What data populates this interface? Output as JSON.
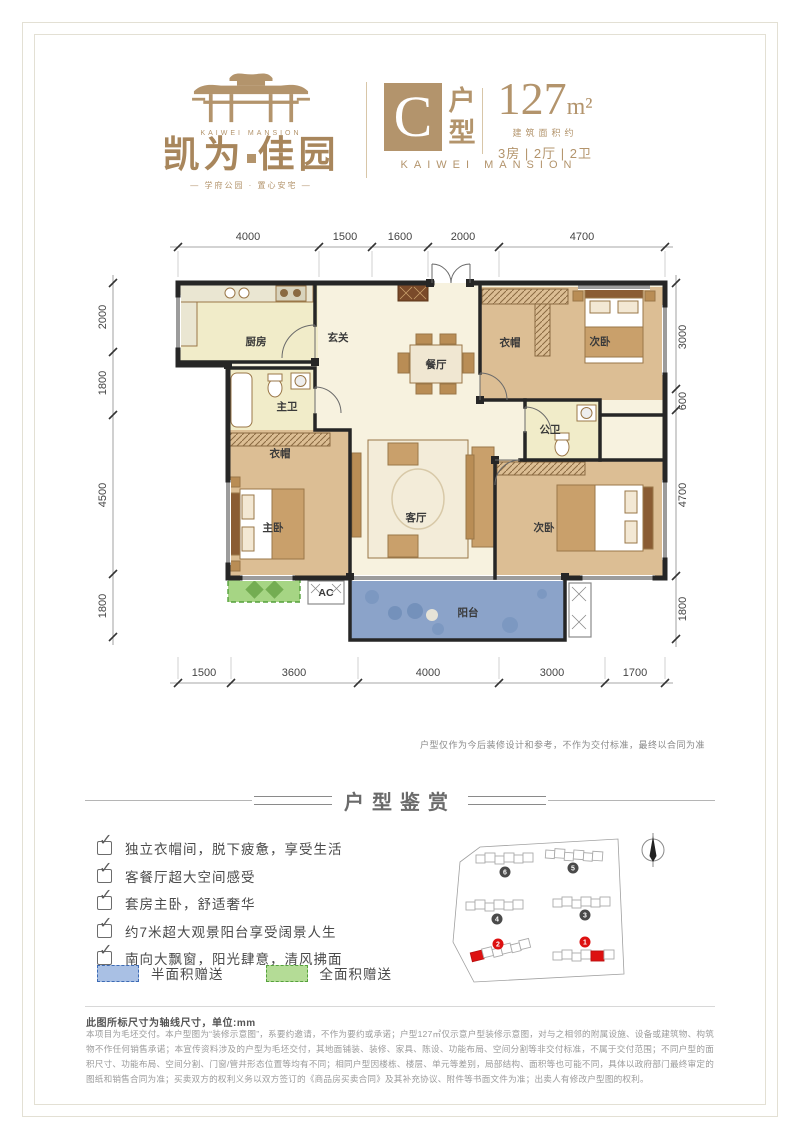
{
  "colors": {
    "accent": "#b3946c",
    "wall": "#262626",
    "balcony_fill": "#8ba3c9",
    "balcony_border": "#3c66ad",
    "gift_green_fill": "#a6d584",
    "gift_green_border": "#55a13c",
    "legend_blue": "#a9c0e4",
    "legend_blue_border": "#3d6bb5"
  },
  "icons": {
    "check": "✓"
  },
  "brand": {
    "logo_en": "KAIWEI MANSION",
    "logo_cn_left": "凯为",
    "logo_cn_right": "佳园",
    "tagline": "— 学府公园 · 置心安宅 —"
  },
  "header": {
    "unit_letter": "C",
    "unit_type_top": "户",
    "unit_type_bottom": "型",
    "area_value": "127",
    "area_unit": "m²",
    "area_note": "建筑面积约",
    "room_config": "3房 | 2厅 | 2卫",
    "brand_en": "KAIWEI MANSION"
  },
  "floorplan": {
    "dims": {
      "top": [
        "4000",
        "1500",
        "1600",
        "2000",
        "4700"
      ],
      "left": [
        "2000",
        "1800",
        "4500",
        "1800"
      ],
      "right": [
        "3000",
        "600",
        "4700",
        "1800"
      ],
      "bottom": [
        "1500",
        "3600",
        "4000",
        "3000",
        "1700"
      ]
    },
    "rooms": {
      "kitchen": "厨房",
      "entry": "玄关",
      "closet_top": "衣帽",
      "bedroom_top": "次卧",
      "master_bath": "主卫",
      "closet_mid": "衣帽",
      "public_bath": "公卫",
      "dining": "餐厅",
      "living": "客厅",
      "master_bedroom": "主卧",
      "bedroom_bottom": "次卧",
      "balcony": "阳台",
      "ac": "AC"
    },
    "note": "户型仅作为今后装修设计和参考，不作为交付标准，最终以合同为准"
  },
  "appreciation": {
    "title": "户型鉴赏",
    "features": [
      "独立衣帽间，脱下疲惫，享受生活",
      "客餐厅超大空间感受",
      "套房主卧，舒适奢华",
      "约7米超大观景阳台享受阔景人生",
      "南向大飘窗，阳光肆意，清风拂面"
    ],
    "legend": [
      {
        "label": "半面积赠送"
      },
      {
        "label": "全面积赠送"
      }
    ]
  },
  "sitemap": {
    "markers": [
      "6",
      "5",
      "4",
      "3",
      "2",
      "1"
    ]
  },
  "footnote": "此图所标尺寸为轴线尺寸，单位:mm",
  "disclaimer": "本项目为毛坯交付。本户型图为“装修示意图”，系要约邀请，不作为要约或承诺；户型127㎡仅示意户型装修示意图，对与之相邻的附属设施、设备或建筑物、构筑物不作任何销售承诺；本宣传资料涉及的户型为毛坯交付，其地面铺装、装修、家具、陈设、功能布局、空间分割等非交付标准，不属于交付范围；不同户型的面积尺寸、功能布局、空间分割、门窗/管井形态位置等均有不同；相同户型因楼栋、楼层、单元等差别，局部结构、面积等也可能不同，具体以政府部门最终审定的图纸和销售合同为准；买卖双方的权利义务以双方签订的《商品房买卖合同》及其补充协议、附件等书面文件为准；出卖人有修改户型图的权利。"
}
